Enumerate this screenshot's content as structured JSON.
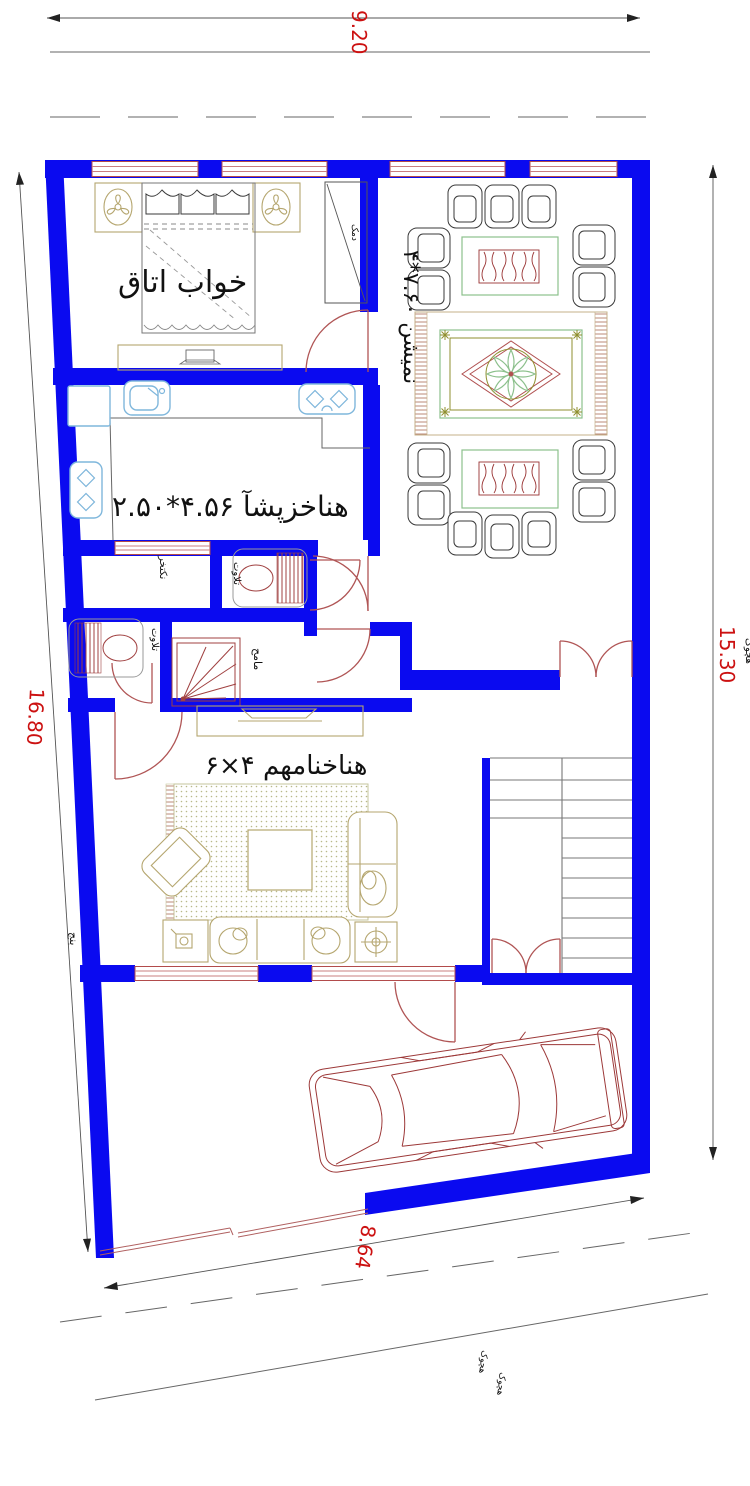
{
  "drawing_title": "house-floor-plan",
  "dimensions": {
    "top": "9.20",
    "right": "15.30",
    "left": "16.80",
    "bottom": "8.64"
  },
  "rooms": {
    "bedroom": {
      "label": "قاتا باوخ"
    },
    "living": {
      "label": "۴*۷.۶۰ نشیمن"
    },
    "kitchen": {
      "label": "۲.۵۰*۴.۵۶ آشپزخانه"
    },
    "hall": {
      "label": "۶×۴ مهمانخانه"
    },
    "toilet_top": {
      "label": "توالت"
    },
    "toilet_bottom": {
      "label": "توالت"
    },
    "shower": {
      "label": "حمام"
    },
    "dressing": {
      "label": "رختکن"
    },
    "closet": {
      "label": "کمد"
    }
  },
  "annotations": {
    "neighbor_left": "جنب",
    "alley_right": "کوچه",
    "alley_bottom_1": "کوچه",
    "alley_bottom_2": "کوچه"
  },
  "colors": {
    "wall": "#0a0af0",
    "window_frame": "#b24b4b",
    "dimension_text": "#cc1111",
    "door_arc": "#b05555",
    "fixture_blue": "#7fb7dc",
    "table_border_green": "#8cc08c",
    "wood_grain": "#993333",
    "rug_medallion": "#b05050",
    "furniture_tan": "#b5a66f",
    "street_line": "#555555"
  }
}
